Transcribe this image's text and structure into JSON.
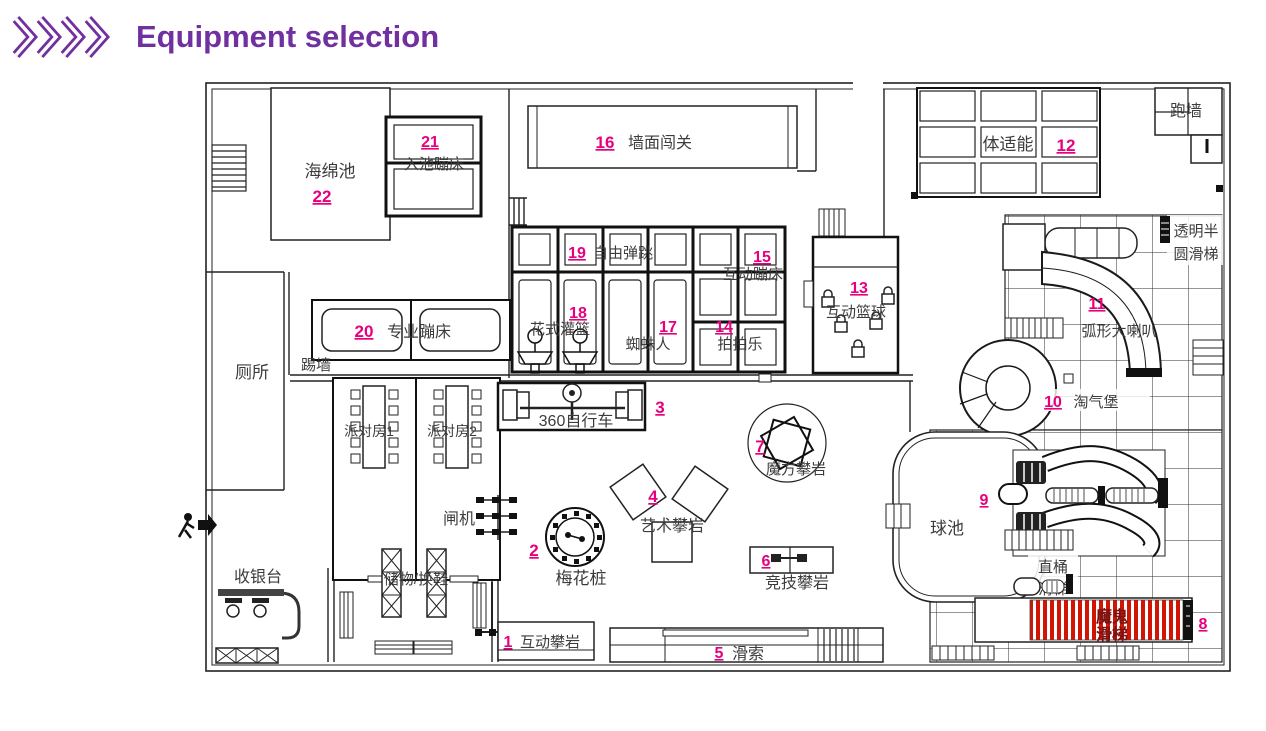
{
  "header": {
    "title": "Equipment selection"
  },
  "colors": {
    "accent": "#7030a0",
    "number_pink": "#e6007e",
    "stripe_red": "#d21404",
    "line": "#222222"
  },
  "plan": {
    "items": [
      {
        "num": "1",
        "label": "互动攀岩"
      },
      {
        "num": "2",
        "label": "梅花桩"
      },
      {
        "num": "3",
        "label": "360自行车"
      },
      {
        "num": "4",
        "label": "艺术攀岩"
      },
      {
        "num": "5",
        "label": "滑索"
      },
      {
        "num": "6",
        "label": "竞技攀岩"
      },
      {
        "num": "7",
        "label": "魔方攀岩"
      },
      {
        "num": "8",
        "label": "魔鬼滑梯",
        "line1": "魔鬼",
        "line2": "滑梯"
      },
      {
        "num": "9",
        "label": ""
      },
      {
        "num": "10",
        "label": "淘气堡"
      },
      {
        "num": "11",
        "label": "弧形大喇叭"
      },
      {
        "num": "12",
        "label": "体适能"
      },
      {
        "num": "13",
        "label": "互动篮球"
      },
      {
        "num": "14",
        "label": "拍拍乐"
      },
      {
        "num": "15",
        "label": "互动蹦床"
      },
      {
        "num": "16",
        "label": "墙面闯关"
      },
      {
        "num": "17",
        "label": "蜘蛛人"
      },
      {
        "num": "18",
        "label": "花式灌篮"
      },
      {
        "num": "19",
        "label": "自由弹跳"
      },
      {
        "num": "20",
        "label": "专业蹦床"
      },
      {
        "num": "21",
        "label": "入池蹦床"
      },
      {
        "num": "22",
        "label": "海绵池"
      }
    ],
    "rooms": {
      "toilet": "厕所",
      "kick_wall": "踢墙",
      "party1": "派对房1",
      "party2": "派对房2",
      "gate": "闸机",
      "cashier": "收银台",
      "storage": "储物/换鞋",
      "ball_pool": "球池",
      "run_wall": "跑墙",
      "transparent_slide": {
        "line1": "透明半",
        "line2": "圆滑梯",
        "full": "透明半圆滑梯"
      },
      "barrel_slide": {
        "line1": "直桶",
        "line2": "滑梯",
        "full": "直桶滑梯"
      }
    }
  }
}
